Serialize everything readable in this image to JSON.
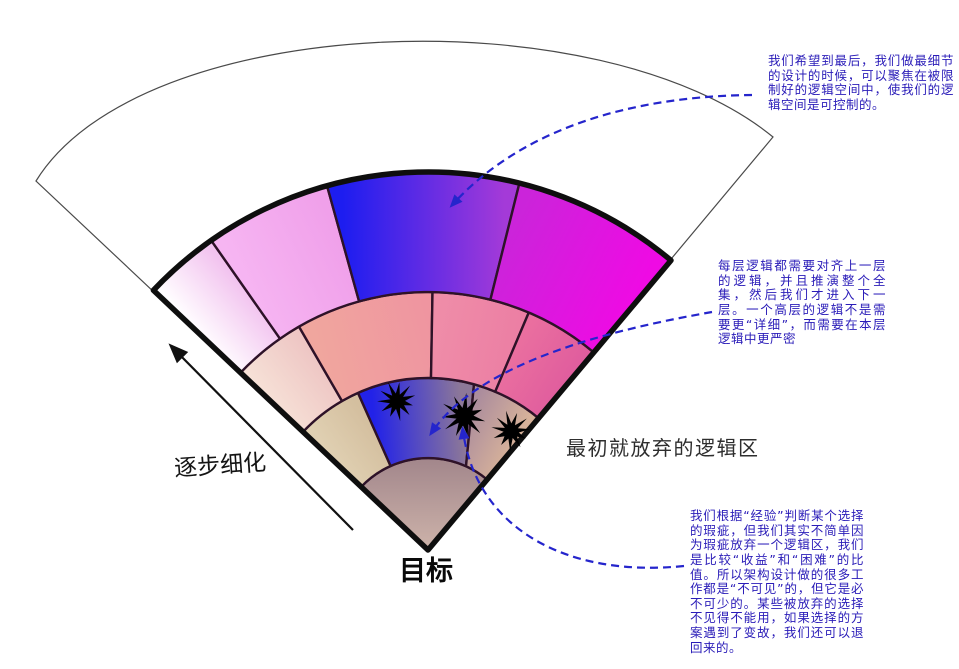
{
  "canvas": {
    "width": 959,
    "height": 669,
    "background": "#ffffff"
  },
  "colors": {
    "annotation_text": "#2a1cb8",
    "dashed_line": "#2525cc",
    "fan_outline": "#0e0e0e",
    "outer_sector_line": "#4a4a4a",
    "segment_stroke": "#2e1228",
    "star_fill": "#000000",
    "label_text": "#1a1a1a"
  },
  "labels": {
    "goal": "目标",
    "refine": "逐步细化",
    "abandoned_region": "最初就放弃的逻辑区"
  },
  "annotations": {
    "top": {
      "text": "我们希望到最后，我们做最细节的设计的时候，可以聚焦在被限制好的逻辑空间中，使我们的逻辑空间是可控制的。"
    },
    "middle": {
      "text": "每层逻辑都需要对齐上一层的逻辑，并且推演整个全集，然后我们才进入下一层。一个高层的逻辑不是需要更“详细”，而需要在本层逻辑中更严密"
    },
    "bottom": {
      "text": "我们根据“经验”判断某个选择的瑕疵，但我们其实不简单因为瑕疵放弃一个逻辑区，我们是比较“收益”和“困难”的比值。所以架构设计做的很多工作都是“不可见”的，但它是必不可少的。某些被放弃的选择不见得不能用，如果选择的方案遇到了变故，我们还可以退回来的。"
    }
  },
  "fan": {
    "apex": [
      428,
      550
    ],
    "angle_left": 136.6,
    "angle_right": 50,
    "outline_radius": 378,
    "outer_sector": {
      "radius": 538,
      "arc": [
        [
          36,
          181
        ],
        [
          140,
          12
        ],
        [
          600,
          -5
        ],
        [
          773,
          137
        ]
      ]
    },
    "rings": [
      {
        "r0": 0,
        "r1": 92,
        "segments": [
          {
            "name": "core-goal",
            "a_left": 136.6,
            "a_right": 50,
            "colors": [
              "#9f8389",
              "#d0b6ac"
            ],
            "grad_pts": [
              [
                428,
                452
              ],
              [
                428,
                556
              ]
            ]
          }
        ]
      },
      {
        "r0": 92,
        "r1": 172,
        "segments": [
          {
            "name": "khaki-left",
            "a_left": 136.6,
            "a_right": 114,
            "colors": [
              "#e0d0b2",
              "#d4bf9f"
            ]
          },
          {
            "name": "blue-focus",
            "a_left": 114,
            "a_right": 74.5,
            "a_right_in": 65.6,
            "colors": [
              "#2222e8",
              "#8d7898"
            ]
          },
          {
            "name": "tan-right",
            "a_left": 74.5,
            "a_left_in": 65.6,
            "a_right": 50,
            "colors": [
              "#ab8c9d",
              "#d7b29a"
            ]
          }
        ]
      },
      {
        "r0": 172,
        "r1": 258,
        "segments": [
          {
            "name": "blush-left",
            "a_left": 136.6,
            "a_right": 120,
            "colors": [
              "#f6e0d6",
              "#eec6c4"
            ]
          },
          {
            "name": "salmon",
            "a_left": 120,
            "a_right": 89,
            "colors": [
              "#f0a69e",
              "#ef95a0"
            ]
          },
          {
            "name": "rose",
            "a_left": 89,
            "a_right": 67,
            "colors": [
              "#ef8da8",
              "#ec7fa4"
            ]
          },
          {
            "name": "deep-rose",
            "a_left": 67,
            "a_right": 50,
            "colors": [
              "#ea6f9f",
              "#e05d9e"
            ]
          }
        ]
      },
      {
        "r0": 258,
        "r1": 378,
        "segments": [
          {
            "name": "white-pink",
            "a_left": 136.6,
            "a_right": 125,
            "colors": [
              "#fffdff",
              "#f2c3ef"
            ]
          },
          {
            "name": "orchid",
            "a_left": 125,
            "a_right": 105.5,
            "colors": [
              "#f6b5f2",
              "#f0a0ea"
            ]
          },
          {
            "name": "blue-violet",
            "a_left": 105.5,
            "a_right": 76,
            "colors": [
              "#1d1df0",
              "#a43ad8"
            ]
          },
          {
            "name": "magenta",
            "a_left": 76,
            "a_right": 50,
            "colors": [
              "#cb24da",
              "#ef0ae4"
            ]
          }
        ]
      }
    ]
  },
  "stars": [
    {
      "cx": 397,
      "cy": 401,
      "r": 19,
      "rot": 0.3
    },
    {
      "cx": 464,
      "cy": 416,
      "r": 22,
      "rot": 0.9
    },
    {
      "cx": 511,
      "cy": 431,
      "r": 19,
      "rot": 0.1
    }
  ],
  "dashed_curves": [
    {
      "name": "to-blue-violet-segment",
      "p0": [
        752,
        95
      ],
      "c1": [
        650,
        96
      ],
      "c2": [
        530,
        120
      ],
      "p1": [
        453,
        204
      ]
    },
    {
      "name": "to-blue-focus-segment",
      "p0": [
        712,
        312
      ],
      "c1": [
        610,
        330
      ],
      "c2": [
        480,
        362
      ],
      "p1": [
        432,
        432
      ]
    },
    {
      "name": "to-star-2",
      "p0": [
        684,
        566
      ],
      "c1": [
        566,
        578
      ],
      "c2": [
        476,
        528
      ],
      "p1": [
        463,
        431
      ]
    }
  ],
  "refine_arrow": {
    "from": [
      353,
      530
    ],
    "to": [
      172,
      347
    ]
  }
}
